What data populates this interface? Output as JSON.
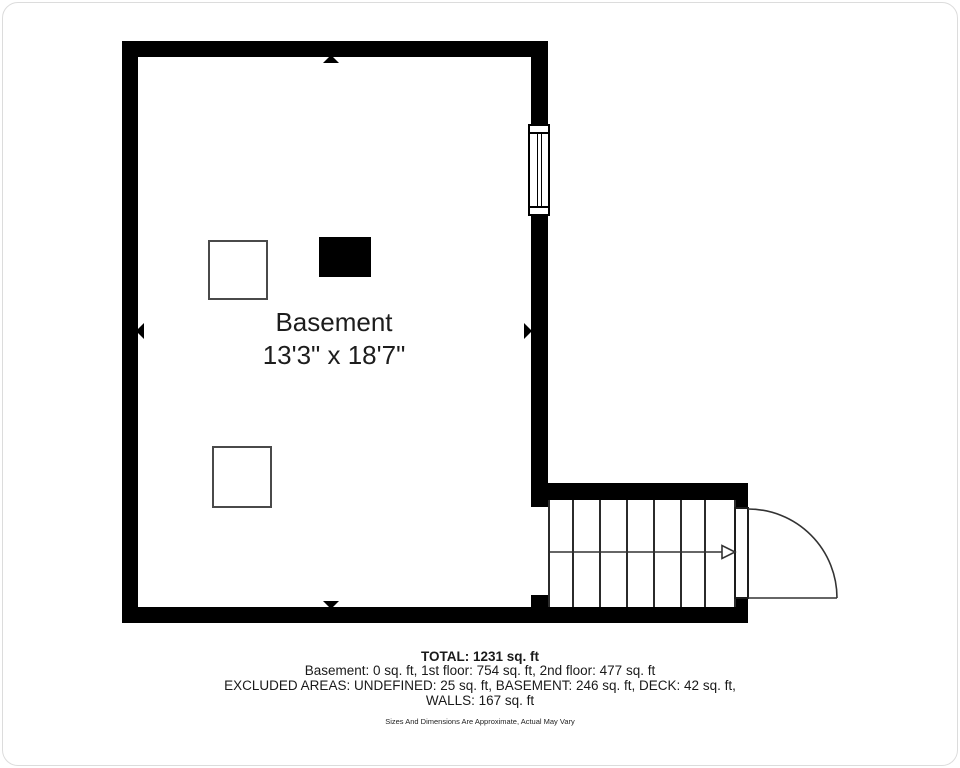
{
  "floorplan": {
    "room": {
      "name": "Basement",
      "dimensions": "13'3\" x 18'7\""
    },
    "summary": {
      "total": "TOTAL: 1231 sq. ft",
      "floor_breakdown": "Basement: 0 sq. ft, 1st floor: 754 sq. ft, 2nd floor: 477 sq. ft",
      "excluded_areas": "EXCLUDED AREAS: UNDEFINED: 25 sq. ft, BASEMENT: 246 sq. ft, DECK: 42 sq. ft,",
      "excluded_walls": "WALLS: 167 sq. ft",
      "disclaimer": "Sizes And Dimensions Are Approximate, Actual May Vary"
    },
    "symbols": {
      "window": "window-symbol",
      "door": "door-swing-symbol",
      "stairs": "staircase-symbol",
      "stairs_arrow": "stairs-direction-arrow"
    },
    "colors": {
      "wall": "#000000",
      "background": "#ffffff",
      "line": "#333333",
      "text": "#1d1d1d",
      "frame_border": "#dcdcdc"
    }
  }
}
